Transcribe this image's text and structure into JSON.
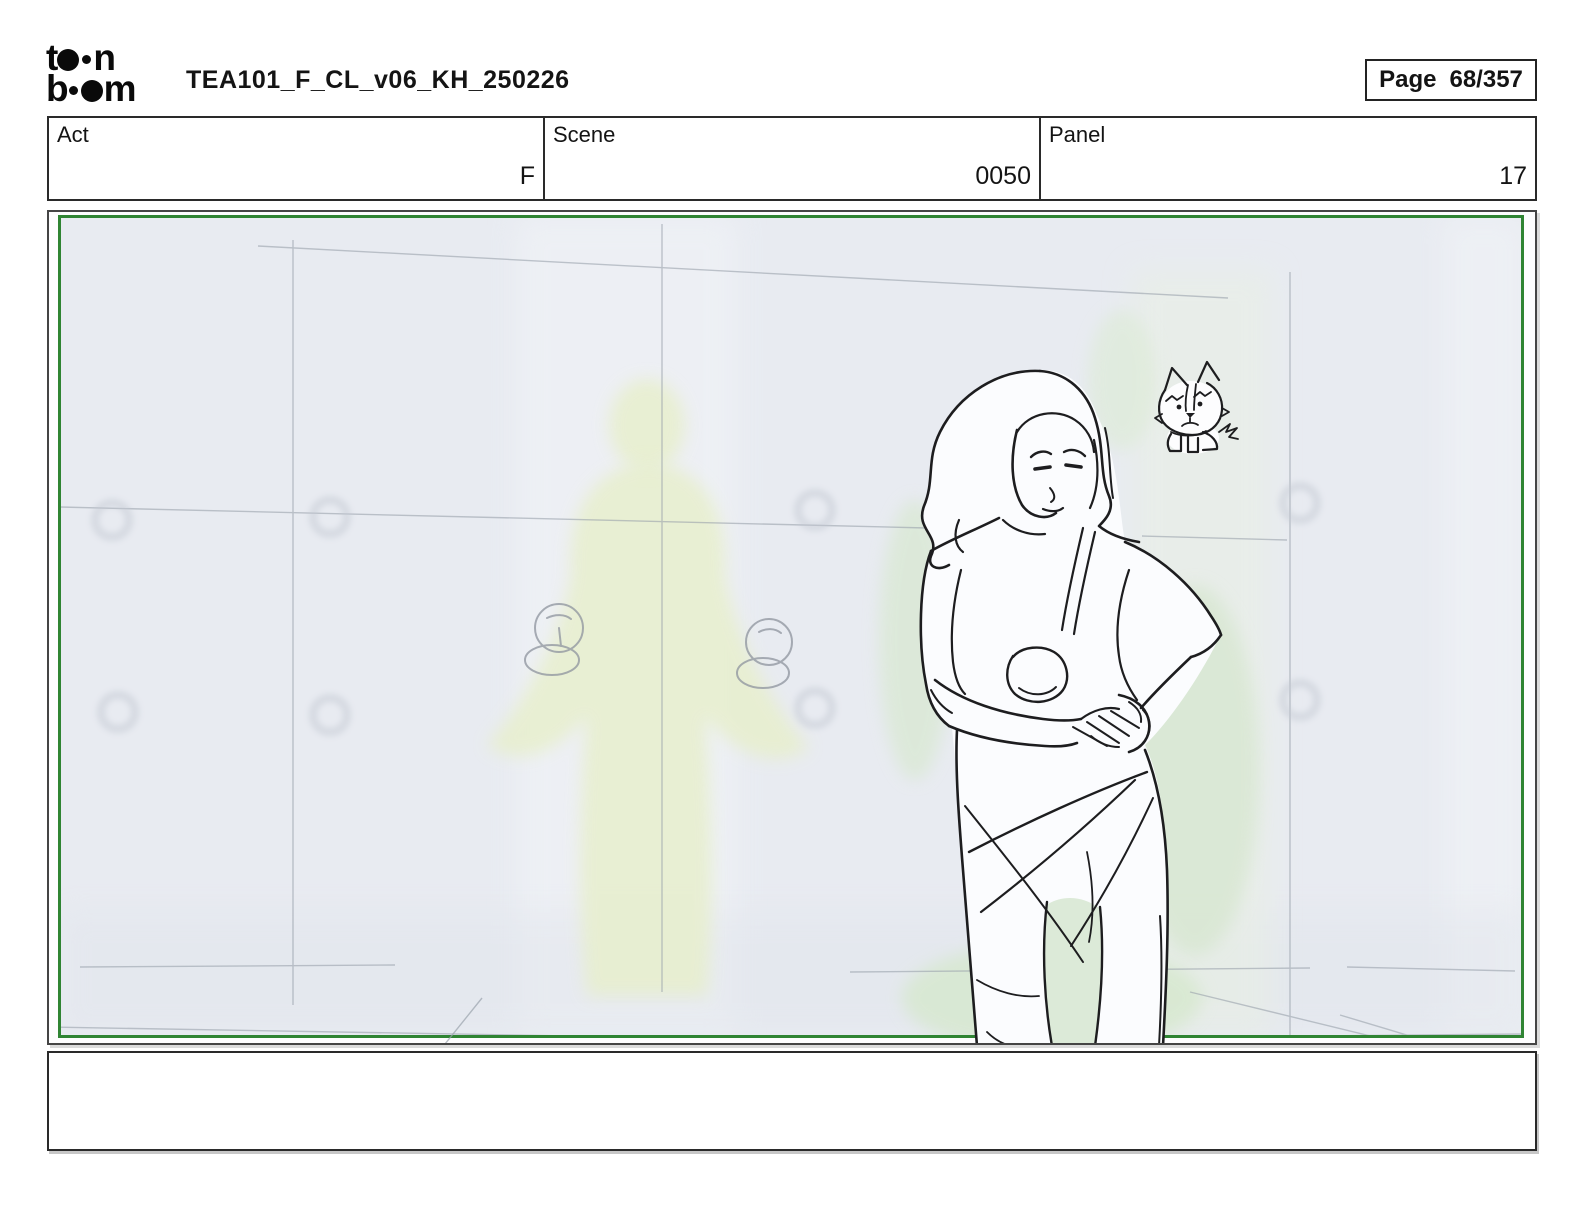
{
  "header": {
    "logo_alt": "toon boom",
    "logo_top_left": "t",
    "logo_top_right": "n",
    "logo_bottom_left": "b",
    "logo_bottom_right": "m",
    "title": "TEA101_F_CL_v06_KH_250226",
    "page_label": "Page",
    "page_value": "68/357"
  },
  "info_table": {
    "cells": [
      {
        "label": "Act",
        "value": "F"
      },
      {
        "label": "Scene",
        "value": "0050"
      },
      {
        "label": "Panel",
        "value": "17"
      }
    ]
  },
  "panel": {
    "frame_color": "#2f8433",
    "canvas_color": "#e8ebf1",
    "sketch_ink_color": "#1d1d1f",
    "glow_color": "#d8e8d0",
    "figures": [
      "woman-wrapping-towel-sketch",
      "grumpy-puppy-sketch",
      "glowing-silhouette",
      "wall-grid-lines"
    ]
  },
  "caption": {
    "text": ""
  }
}
